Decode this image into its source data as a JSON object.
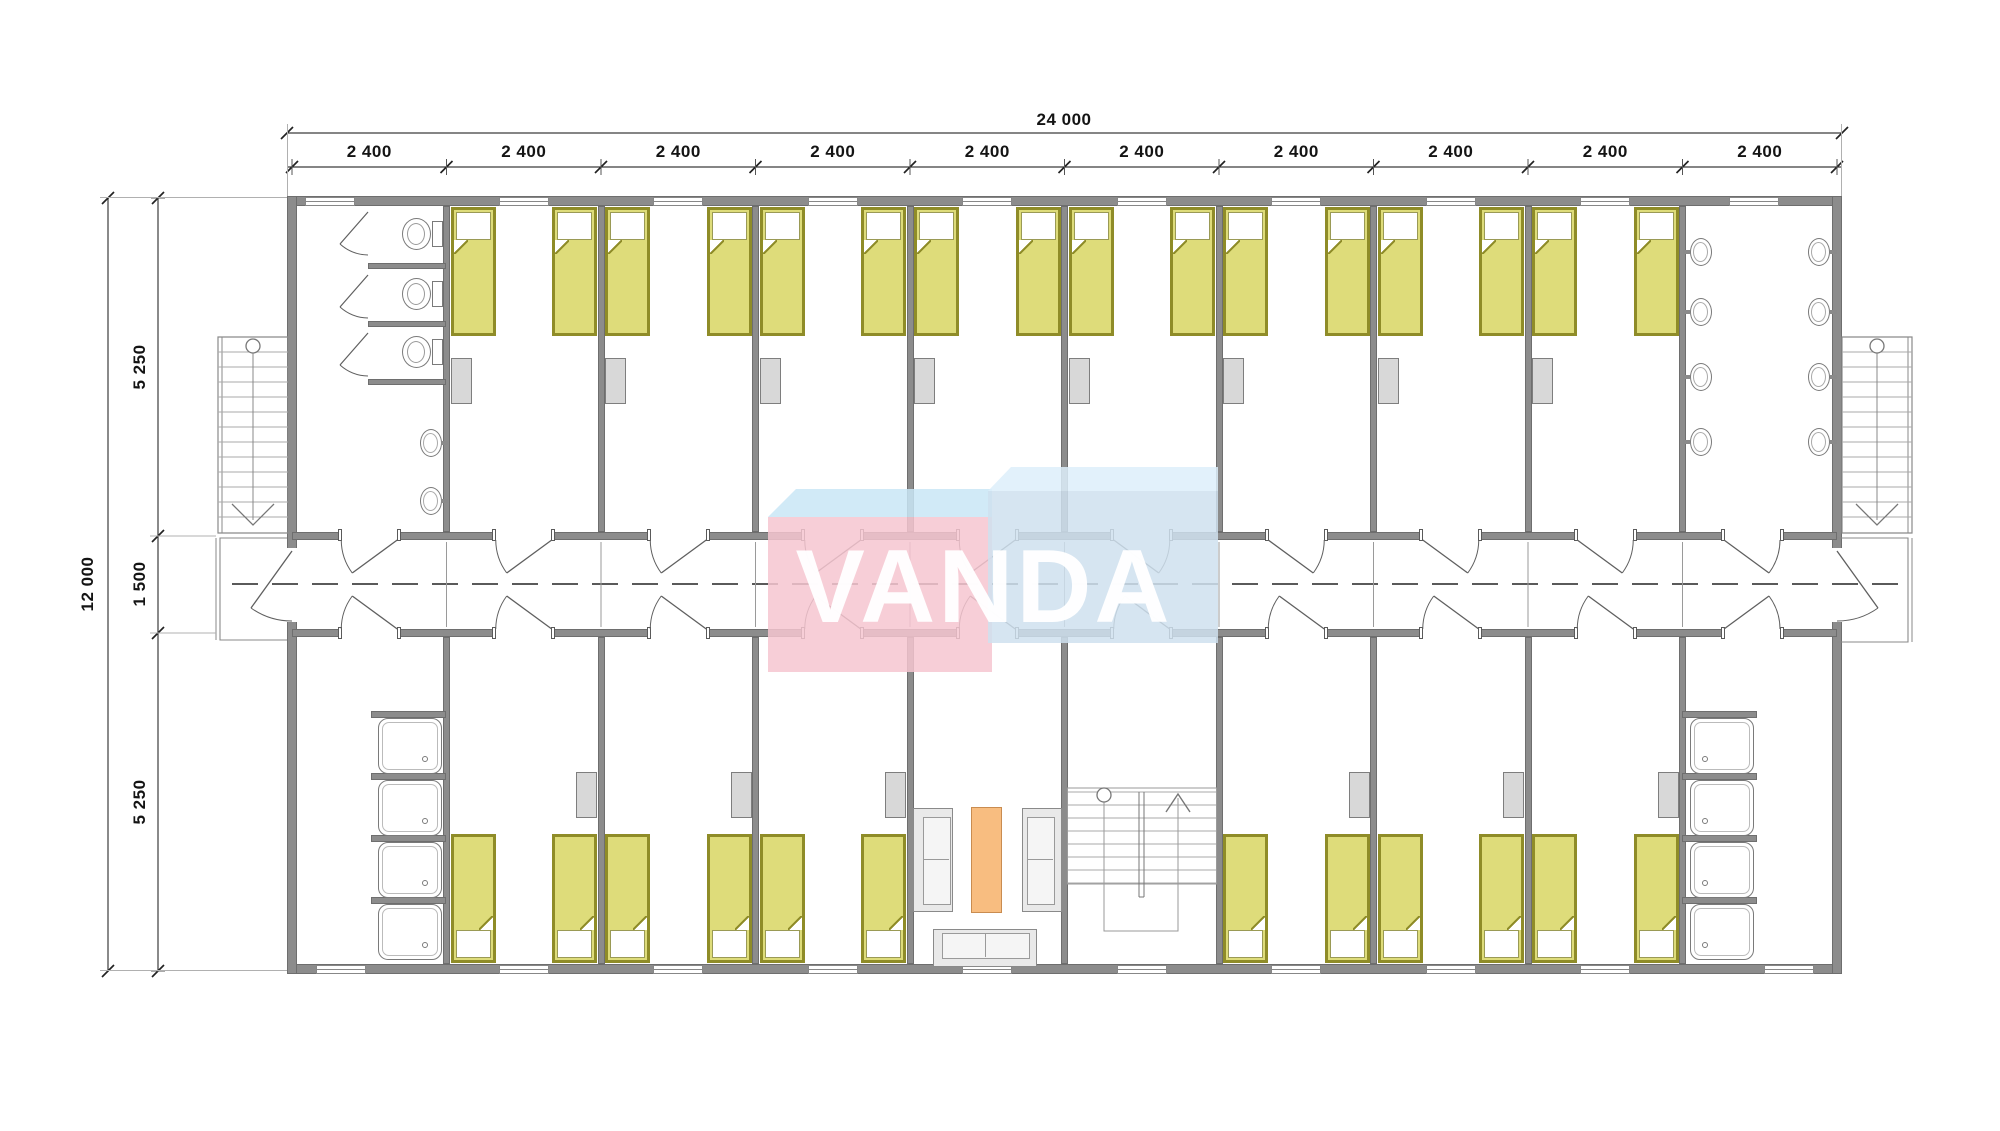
{
  "page": {
    "type": "architectural-floor-plan",
    "background": "#ffffff"
  },
  "logo": {
    "text": "VANDA",
    "colors": {
      "pink": "#f6c6ce",
      "sky_band": "#c9e6f6",
      "blue": "#cfe1ef",
      "blue_band": "#ddeefa",
      "letters": "#ffffff"
    }
  },
  "dimensions": {
    "overall_width": "24 000",
    "bay_width": "2 400",
    "overall_depth": "12 000",
    "depth_top": "5 250",
    "corridor_width": "1 500",
    "depth_bottom": "5 250"
  },
  "plan_colors": {
    "wall": "#8c8c8c",
    "bed_fill": "#dedc7a",
    "bed_frame": "#8f8c28",
    "furniture_grey": "#d8d8d8",
    "table_orange": "#f8bd80"
  }
}
